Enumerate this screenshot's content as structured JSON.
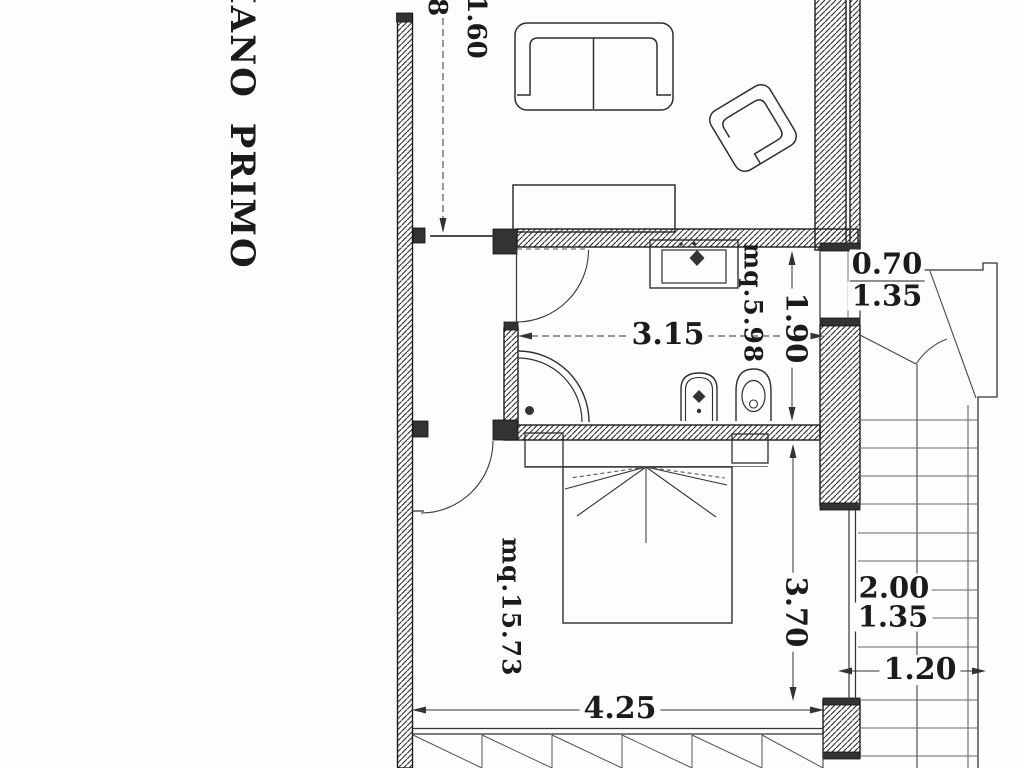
{
  "floor_plan": {
    "title": "PIANO PRIMO",
    "dimensions": {
      "living_height_partial": "8",
      "living_width": "1.60",
      "bath_width": "3.15",
      "bath_depth": "1.90",
      "bath_area": "mq.5.98",
      "bath_window_width": "0.70",
      "bath_window_height": "1.35",
      "bedroom_area": "mq.15.73",
      "bedroom_depth": "3.70",
      "bedroom_width": "4.25",
      "bedroom_window_width": "2.00",
      "bedroom_window_height": "1.35",
      "stair_width": "1.20"
    }
  }
}
